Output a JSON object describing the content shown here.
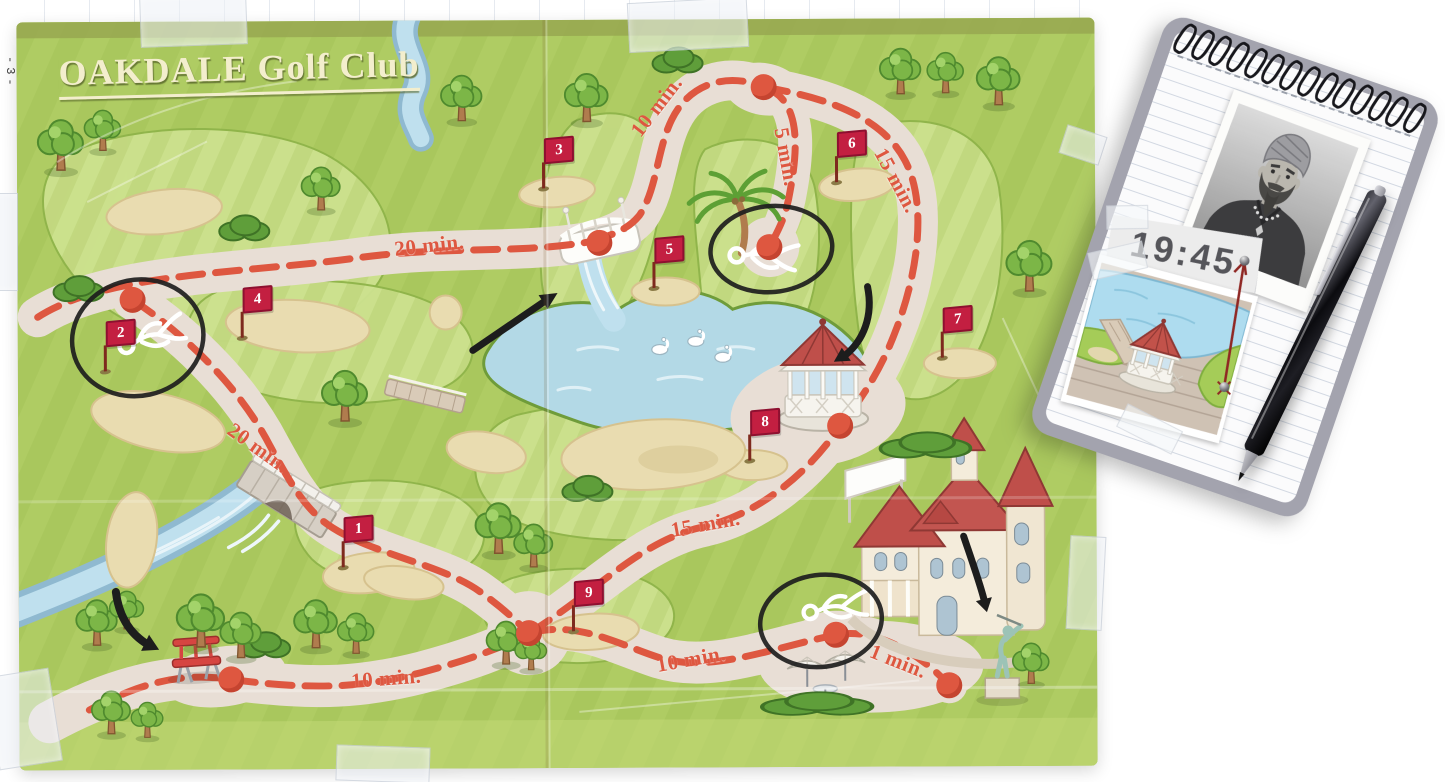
{
  "colors": {
    "map-green": "#afcc63",
    "fairway-light": "#cde28f",
    "path-cream": "#e8ded5",
    "route-red": "#de5740",
    "flag-red": "#c31f41",
    "lake-blue": "#b3d9e6",
    "sand": "#e9dcb0",
    "tree-green": "#7cb647",
    "roof-red": "#bf4f4a",
    "wall-cream": "#f4ecdb",
    "annotation-black": "#1d1d1d",
    "chalk-white": "#ffffff",
    "pad-grey": "#a3a3ae",
    "paper-white": "#fbfbfc",
    "pen-black": "#1a1a1e",
    "string-red": "#8f2723",
    "title-cream": "#f3eecd",
    "time-grey": "#55555a"
  },
  "map": {
    "title": "OAKDALE Golf Club",
    "page_marker": "-3-",
    "flags": [
      "1",
      "2",
      "3",
      "4",
      "5",
      "6",
      "7",
      "8",
      "9"
    ],
    "time_labels": [
      "20 min.",
      "10 min.",
      "5 min.",
      "15 min.",
      "20 min.",
      "15 min.",
      "10 min.",
      "10 min.",
      "1 min."
    ]
  },
  "notepad": {
    "time": "19:45"
  }
}
